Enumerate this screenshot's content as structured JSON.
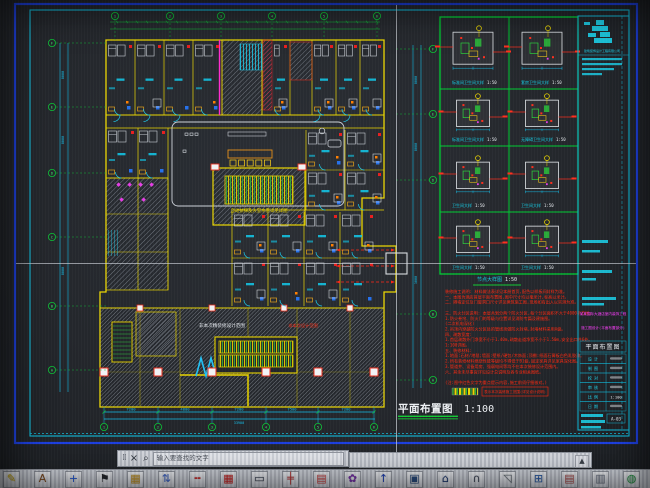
{
  "window": {
    "kind": "CAD drawing viewport photo",
    "cursor": "crosshair"
  },
  "drawing": {
    "main_label": "平面布置图",
    "main_scale": "1:100",
    "detail_section_label": "节点大样图",
    "detail_section_scale": "1:50",
    "details": [
      {
        "caption": "标准间卫生间大样",
        "scale": "1:50"
      },
      {
        "caption": "套房卫生间大样",
        "scale": "1:50"
      },
      {
        "caption": "标准间卫生间大样",
        "scale": "1:50"
      },
      {
        "caption": "无障碍卫生间大样",
        "scale": "1:50"
      },
      {
        "caption": "卫生间大样",
        "scale": "1:50"
      },
      {
        "caption": "卫生间大样",
        "scale": "1:50"
      },
      {
        "caption": "卫生间大样",
        "scale": "1:50"
      },
      {
        "caption": "卫生间大样",
        "scale": "1:50"
      }
    ],
    "grid_bubbles": {
      "top": [
        "1",
        "2",
        "3",
        "4",
        "5",
        "6"
      ],
      "bottom": [
        "1",
        "2",
        "3",
        "4",
        "5",
        "6"
      ],
      "left": [
        "F",
        "E",
        "D",
        "C",
        "B",
        "A"
      ],
      "right": [
        "F",
        "E",
        "D",
        "B",
        "A"
      ]
    },
    "dims": {
      "bottom": [
        "7200",
        "4800",
        "7200",
        "7500",
        "7200"
      ],
      "bottom_total": "33900",
      "left": [
        "8000",
        "8000",
        "8000"
      ],
      "right": [
        "8000",
        "8000",
        "3000"
      ]
    },
    "plan_texts": {
      "lobby_block_label": "自动扶梯及大堂水景详见详图",
      "hatch_note_white": "非本次精装修设计范围",
      "hatch_note_red": "非本次设计范围"
    },
    "notes": {
      "lines": [
        "装修施工说明: 材料做法表详见本册首页,配色以样板间封样为准。",
        "一、本图为酒店首层平面布置图,图中尺寸均以毫米计,标高以米计。",
        "二、隔墙定位及门窗洞口尺寸详见建筑施工图,现场如有出入以实测为准。",
        "",
        "三、防火分区说明: 本层共划分两个防火分区,每个分区面积不大于4000平方米。",
        "1.防火卷帘、防火门的等级与位置详见消防专篇及建施图。",
        "(二次机电深化)",
        "2.吊顶内穿越防火分区处的管线须做防火封堵,封堵材料采用A级。",
        "四、疏散宽度:",
        "1.首层疏散外门净宽不小于1.40m,疏散走道净宽不小于1.50m,安全出口共6处。",
        "1:100详图。",
        "五、装修材料:",
        "1.地面:石材/地毯;墙面:壁纸/硬包/木饰面;顶棚:纸面石膏板白色乳胶漆。",
        "2.所有装修材料燃烧性能等级均不得低于B1级,固定家具详见家具深化图。",
        "3.管道井、设备用房、强弱电间等均不在本次装修设计范围内。",
        "六、其余未尽事宜详见设计总说明及各专业相关图纸。",
        "",
        "(注:图中红色文字为重点提示内容,施工前须仔细核对。)"
      ],
      "legend_text": "表示本次装修施工范围(详见设计说明)"
    }
  },
  "titleblock": {
    "company": "建筑装饰设计工程有限公司",
    "project_line1": "某某国际大酒店室内装饰工程",
    "project_line2": "施工图设计(平面布置部分)",
    "drawing_title": "平面布置图",
    "table_rows": [
      {
        "label": "设 计",
        "value": ""
      },
      {
        "label": "制 图",
        "value": ""
      },
      {
        "label": "校 对",
        "value": ""
      },
      {
        "label": "审 核",
        "value": ""
      },
      {
        "label": "比 例",
        "value": "1:100"
      },
      {
        "label": "日 期",
        "value": ""
      }
    ],
    "drawing_no": "A-03"
  },
  "find_bar": {
    "close_glyph": "×",
    "search_glyph": "⌕",
    "text": "输入要查找的文字"
  },
  "scrollbar": {
    "arrow_glyph": "▲"
  },
  "toolbar": {
    "icons": [
      {
        "name": "pencil-icon",
        "glyph": "✎",
        "color": "#c8a400"
      },
      {
        "name": "text-style-icon",
        "glyph": "A",
        "color": "#7a4a20"
      },
      {
        "name": "move-icon",
        "glyph": "+",
        "color": "#2255cc"
      },
      {
        "name": "flag-icon",
        "glyph": "⚑",
        "color": "#23262b"
      },
      {
        "name": "table-cells-icon",
        "glyph": "▦",
        "color": "#b88a20"
      },
      {
        "name": "axis-swap-icon",
        "glyph": "⇅",
        "color": "#3a60c0"
      },
      {
        "name": "dim-line-icon",
        "glyph": "╍",
        "color": "#c03030"
      },
      {
        "name": "track-grid-icon",
        "glyph": "▦",
        "color": "#c02020"
      },
      {
        "name": "screen-icon",
        "glyph": "▭",
        "color": "#303848"
      },
      {
        "name": "section-marks-icon",
        "glyph": "╪",
        "color": "#b03030"
      },
      {
        "name": "rail-icon",
        "glyph": "▤",
        "color": "#c04040"
      },
      {
        "name": "plant-icon",
        "glyph": "✿",
        "color": "#7030a0"
      },
      {
        "name": "arrow-up-icon",
        "glyph": "↑",
        "color": "#2040b0"
      },
      {
        "name": "framed-image-icon",
        "glyph": "▣",
        "color": "#284878"
      },
      {
        "name": "building-icon",
        "glyph": "⌂",
        "color": "#203a70"
      },
      {
        "name": "arch-icon",
        "glyph": "∩",
        "color": "#404858"
      },
      {
        "name": "roof-arrow-icon",
        "glyph": "◹",
        "color": "#606870"
      },
      {
        "name": "grid-sheet-icon",
        "glyph": "⊞",
        "color": "#2858a0"
      },
      {
        "name": "schedule-icon",
        "glyph": "▤",
        "color": "#a04848"
      },
      {
        "name": "sheet-icon",
        "glyph": "▥",
        "color": "#687080"
      },
      {
        "name": "globe-icon",
        "glyph": "◍",
        "color": "#209040"
      },
      {
        "name": "card-icon",
        "glyph": "◨",
        "color": "#3868b8"
      }
    ]
  }
}
